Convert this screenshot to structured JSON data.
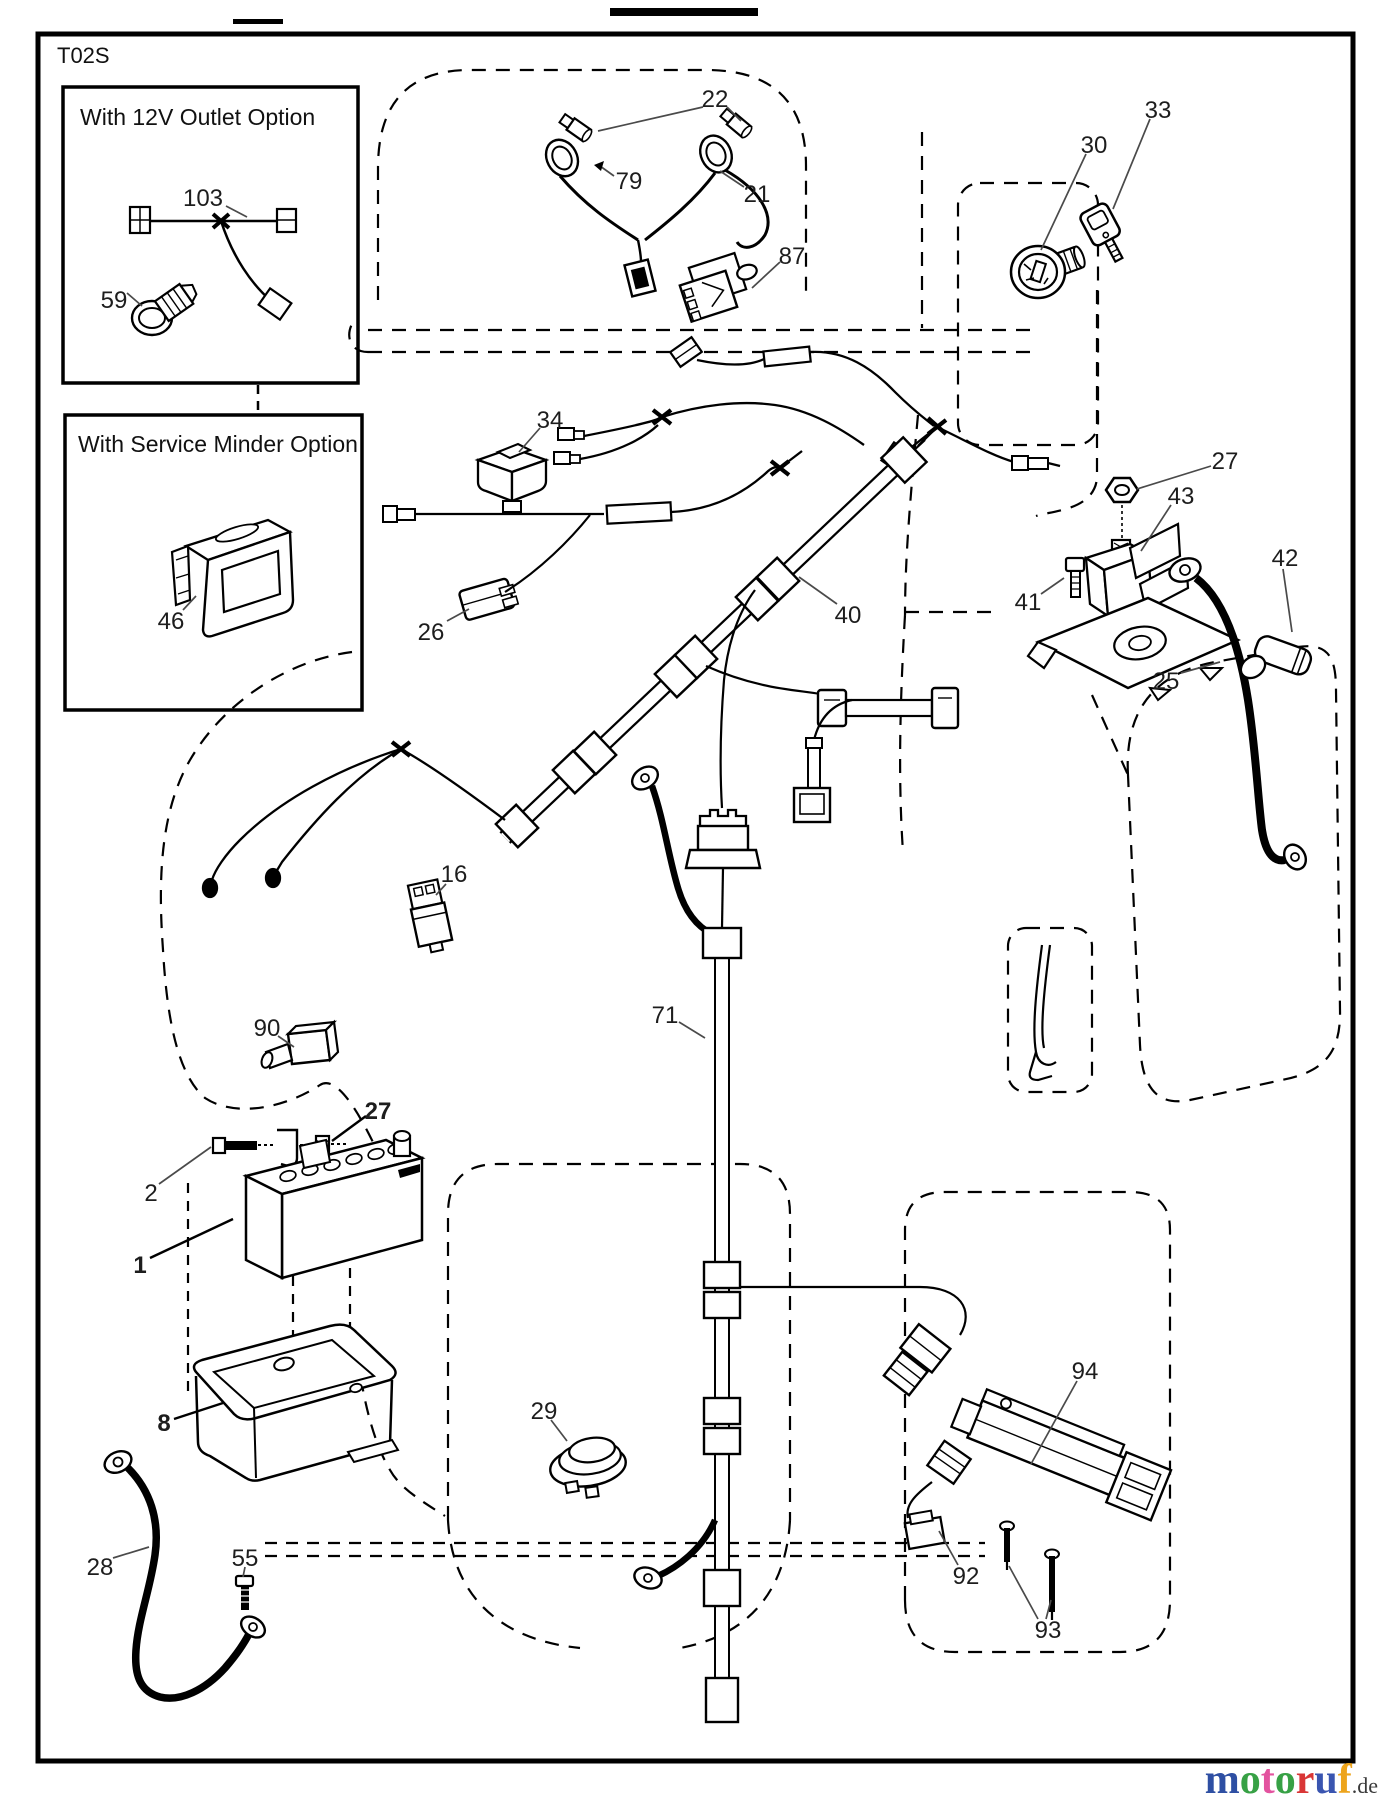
{
  "page": {
    "code": "T02S"
  },
  "insets": [
    {
      "title": "With 12V Outlet Option",
      "parts": [
        "103",
        "59"
      ]
    },
    {
      "title": "With Service Minder Option",
      "parts": [
        "46"
      ]
    }
  ],
  "part_labels": [
    {
      "num": "103",
      "x": 203,
      "y": 198
    },
    {
      "num": "59",
      "x": 114,
      "y": 300
    },
    {
      "num": "46",
      "x": 171,
      "y": 621
    },
    {
      "num": "22",
      "x": 715,
      "y": 99
    },
    {
      "num": "79",
      "x": 629,
      "y": 181
    },
    {
      "num": "21",
      "x": 757,
      "y": 194
    },
    {
      "num": "87",
      "x": 792,
      "y": 256
    },
    {
      "num": "30",
      "x": 1094,
      "y": 145
    },
    {
      "num": "33",
      "x": 1158,
      "y": 110
    },
    {
      "num": "34",
      "x": 550,
      "y": 420
    },
    {
      "num": "26",
      "x": 431,
      "y": 632
    },
    {
      "num": "40",
      "x": 848,
      "y": 615
    },
    {
      "num": "27",
      "x": 1225,
      "y": 461
    },
    {
      "num": "43",
      "x": 1181,
      "y": 496
    },
    {
      "num": "42",
      "x": 1285,
      "y": 558
    },
    {
      "num": "41",
      "x": 1028,
      "y": 602
    },
    {
      "num": "25",
      "x": 1166,
      "y": 681
    },
    {
      "num": "16",
      "x": 454,
      "y": 874
    },
    {
      "num": "90",
      "x": 267,
      "y": 1028
    },
    {
      "num": "27",
      "x": 378,
      "y": 1111,
      "bold": true
    },
    {
      "num": "2",
      "x": 151,
      "y": 1193
    },
    {
      "num": "1",
      "x": 140,
      "y": 1265,
      "bold": true
    },
    {
      "num": "8",
      "x": 164,
      "y": 1423,
      "bold": true
    },
    {
      "num": "28",
      "x": 100,
      "y": 1567
    },
    {
      "num": "55",
      "x": 245,
      "y": 1558
    },
    {
      "num": "29",
      "x": 544,
      "y": 1411
    },
    {
      "num": "71",
      "x": 665,
      "y": 1015
    },
    {
      "num": "92",
      "x": 966,
      "y": 1576
    },
    {
      "num": "93",
      "x": 1048,
      "y": 1630
    },
    {
      "num": "94",
      "x": 1085,
      "y": 1371
    }
  ],
  "watermark": {
    "letters": [
      {
        "ch": "m",
        "color": "#2e4fa3"
      },
      {
        "ch": "o",
        "color": "#37a145"
      },
      {
        "ch": "t",
        "color": "#e3539f"
      },
      {
        "ch": "o",
        "color": "#37a145"
      },
      {
        "ch": "r",
        "color": "#d93636"
      },
      {
        "ch": "u",
        "color": "#3a55b0"
      },
      {
        "ch": "f",
        "color": "#eda41c"
      }
    ],
    "suffix": ".de",
    "suffix_color": "#3a3a3a"
  }
}
